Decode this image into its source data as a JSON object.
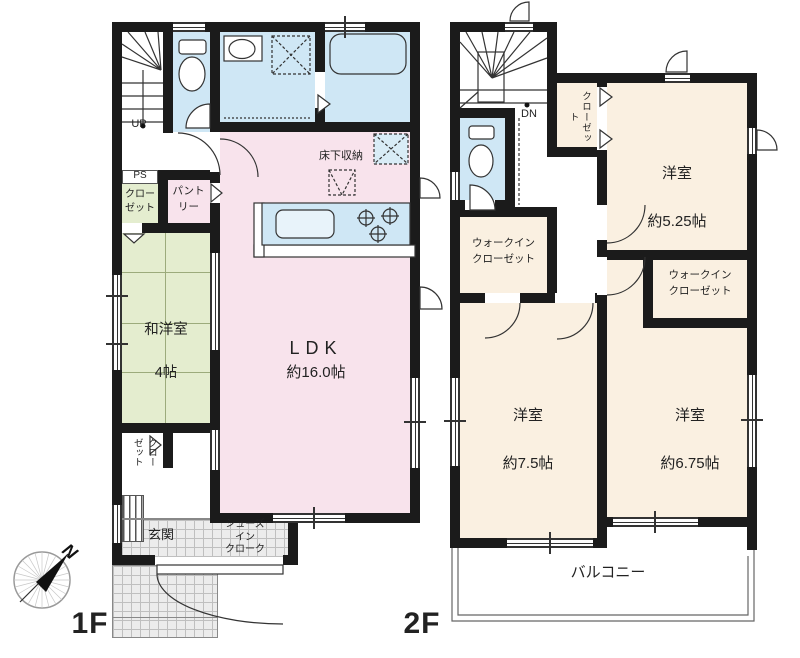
{
  "floors": {
    "f1": {
      "floor_label": "1F",
      "ldk": {
        "name": "LDK",
        "size": "約16.0帖"
      },
      "washitsu": {
        "name": "和洋室",
        "size": "4帖"
      },
      "genkan": "玄関",
      "shoes_in_cloak": "シューズ\nイン\nクローク",
      "pantry": "パント\nリー",
      "ps": "PS",
      "closet_ps": "クロー\nゼット",
      "closet_hall": "クローゼット",
      "underfloor_storage": "床下収納",
      "stairs_up": "UP"
    },
    "f2": {
      "floor_label": "2F",
      "room_525": {
        "name": "洋室",
        "size": "約5.25帖"
      },
      "room_75": {
        "name": "洋室",
        "size": "約7.5帖"
      },
      "room_675": {
        "name": "洋室",
        "size": "約6.75帖"
      },
      "wic_left": "ウォークイン\nクローゼット",
      "wic_right": "ウォークイン\nクローゼット",
      "closet": "クローゼット",
      "balcony": "バルコニー",
      "stairs_down": "DN"
    }
  },
  "compass": {
    "north_label": "N"
  },
  "colors": {
    "wall": "#1b1b1b",
    "room_pink": "#f8e3ec",
    "room_green": "#e4edcf",
    "room_peach": "#faf0e1",
    "water_blue": "#cfe7f5",
    "tile_gray": "#ececec"
  }
}
